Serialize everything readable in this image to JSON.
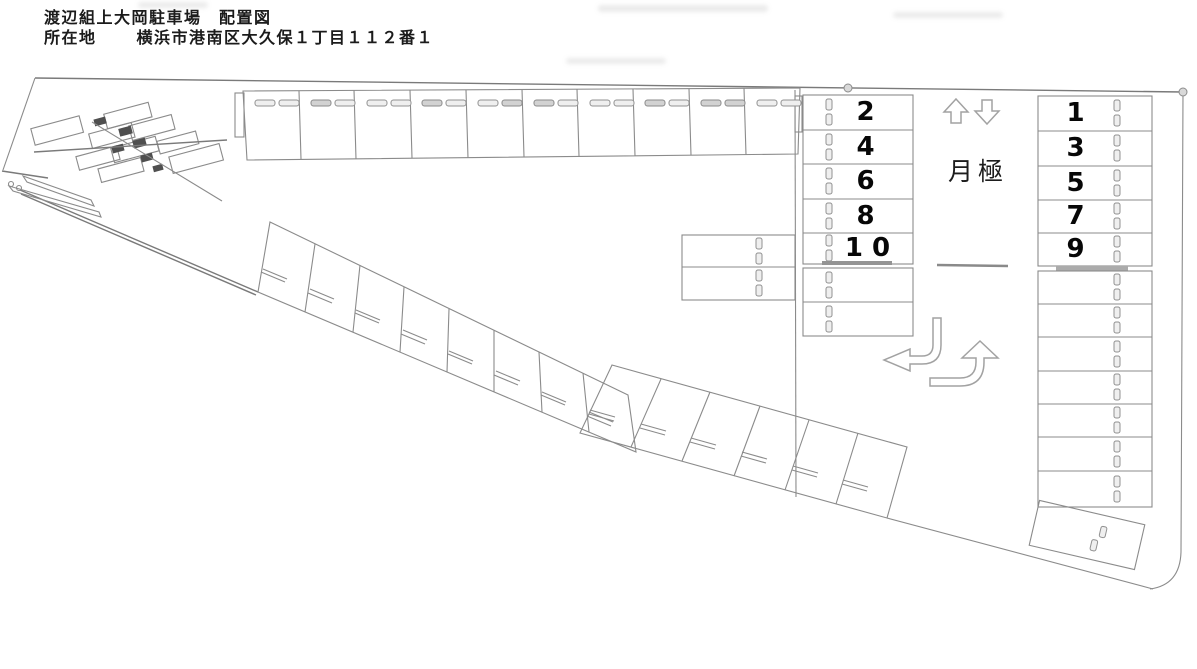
{
  "header": {
    "title": "渡辺組上大岡駐車場　配置図",
    "location_label": "所在地",
    "location_value": "横浜市港南区大久保１丁目１１２番１"
  },
  "area_labels": {
    "monthly": "月極"
  },
  "spaces": {
    "even_column": [
      "2",
      "4",
      "6",
      "8",
      "10"
    ],
    "odd_column": [
      "1",
      "3",
      "5",
      "7",
      "9"
    ]
  },
  "counts": {
    "top_row_spaces": 10,
    "diagonal_row_upper_spaces": 8,
    "diagonal_row_lower_spaces": 6,
    "even_column_unnumbered_spaces": 2,
    "center_side_spaces": 2,
    "odd_column_unnumbered_spaces": 7,
    "tilted_corner_spaces": 1
  },
  "icons": {
    "up_arrow": "up-arrow-icon",
    "down_arrow": "down-arrow-icon",
    "turn_left_arrow": "turn-left-arrow-icon",
    "turn_up_arrow": "turn-up-arrow-icon"
  },
  "colors": {
    "line": "#8b8b8b",
    "text": "#1b1b1b",
    "divider_bar": "#949494",
    "paper": "#ffffff"
  }
}
